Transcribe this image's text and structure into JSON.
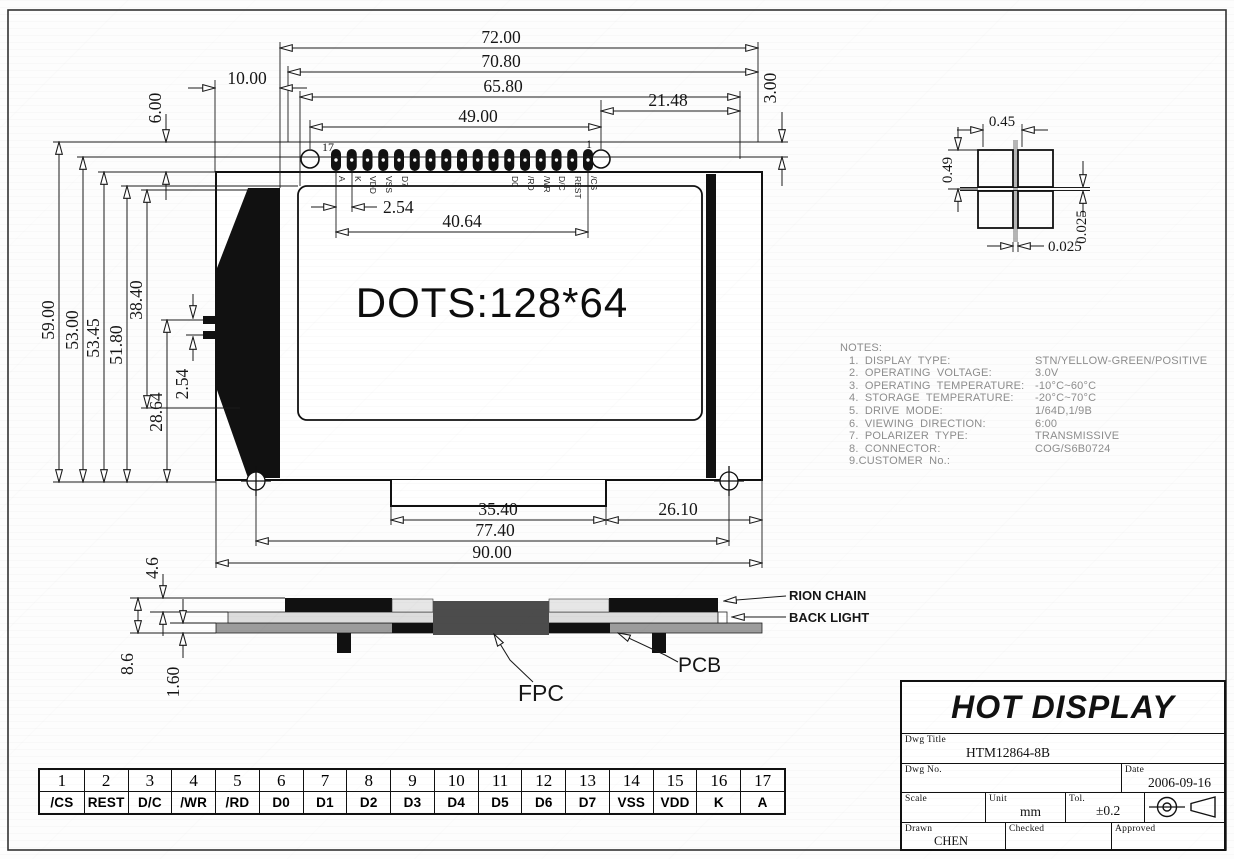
{
  "top_view": {
    "display_text": "DOTS:128*64",
    "pin_number_left": "17",
    "pin_number_right": "1",
    "pad_labels": [
      "A",
      "K",
      "VDD",
      "VSS",
      "D7",
      "D0",
      "/RD",
      "/WR",
      "D/C",
      "REST",
      "/CS"
    ]
  },
  "dims": {
    "d72": "72.00",
    "d70_8": "70.80",
    "d65_8": "65.80",
    "d49": "49.00",
    "d21_48": "21.48",
    "d10": "10.00",
    "d6": "6.00",
    "d3": "3.00",
    "d2_54_pitch": "2.54",
    "d40_64": "40.64",
    "d59": "59.00",
    "d53": "53.00",
    "d53_45": "53.45",
    "d51_8": "51.80",
    "d38_4": "38.40",
    "d28_64": "28.64",
    "d2_54_left": "2.54",
    "d35_4": "35.40",
    "d26_1": "26.10",
    "d77_4": "77.40",
    "d90": "90.00",
    "d4_6": "4.6",
    "d8_6": "8.6",
    "d1_6": "1.60",
    "d0_45": "0.45",
    "d0_49": "0.49",
    "d0_025_v": "0.025",
    "d0_025_h": "0.025"
  },
  "side_view": {
    "rion_chain": "RION CHAIN",
    "back_light": "BACK LIGHT",
    "fpc": "FPC",
    "pcb": "PCB"
  },
  "notes": {
    "heading": "NOTES:",
    "items": [
      {
        "label": "1. DISPLAY TYPE:",
        "value": "STN/YELLOW-GREEN/POSITIVE"
      },
      {
        "label": "2. OPERATING VOLTAGE:",
        "value": "3.0V"
      },
      {
        "label": "3. OPERATING TEMPERATURE:",
        "value": "-10°C~60°C"
      },
      {
        "label": "4. STORAGE TEMPERATURE:",
        "value": "-20°C~70°C"
      },
      {
        "label": "5. DRIVE MODE:",
        "value": "1/64D,1/9B"
      },
      {
        "label": "6. VIEWING DIRECTION:",
        "value": "6:00"
      },
      {
        "label": "7. POLARIZER TYPE:",
        "value": "TRANSMISSIVE"
      },
      {
        "label": "8. CONNECTOR:",
        "value": "COG/S6B0724"
      },
      {
        "label": "9.CUSTOMER No.:",
        "value": ""
      }
    ]
  },
  "pin_table": {
    "numbers": [
      "1",
      "2",
      "3",
      "4",
      "5",
      "6",
      "7",
      "8",
      "9",
      "10",
      "11",
      "12",
      "13",
      "14",
      "15",
      "16",
      "17"
    ],
    "names": [
      "/CS",
      "REST",
      "D/C",
      "/WR",
      "/RD",
      "D0",
      "D1",
      "D2",
      "D3",
      "D4",
      "D5",
      "D6",
      "D7",
      "VSS",
      "VDD",
      "K",
      "A"
    ]
  },
  "title_block": {
    "company": "HOT DISPLAY",
    "dwg_title_label": "Dwg Title",
    "dwg_title": "HTM12864-8B",
    "dwg_no_label": "Dwg No.",
    "dwg_no": "",
    "date_label": "Date",
    "date": "2006-09-16",
    "scale_label": "Scale",
    "scale": "",
    "unit_label": "Unit",
    "unit": "mm",
    "tol_label": "Tol.",
    "tol": "±0.2",
    "drawn_label": "Drawn",
    "drawn": "CHEN",
    "checked_label": "Checked",
    "checked": "",
    "approved_label": "Approved",
    "approved": ""
  }
}
